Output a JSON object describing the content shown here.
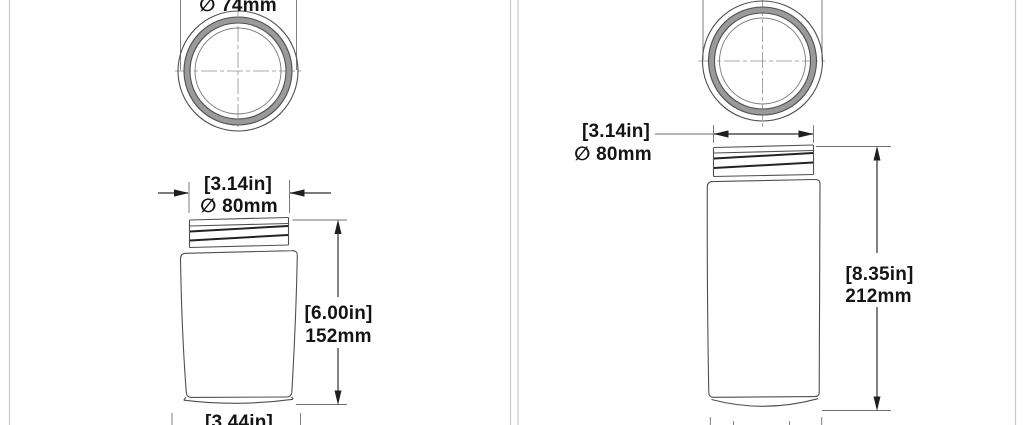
{
  "sheet": {
    "background": "#ffffff",
    "panel_border_color": "#c9c9c9",
    "outline_color": "#4f4f4f",
    "thread_color": "#232323",
    "dimension_color": "#2d2d2d",
    "centerline_color": "#8f8f8f",
    "text_color": "#141414"
  },
  "left_drawing": {
    "top_view": {
      "diameter_label": "∅ 74mm"
    },
    "neck_dimension": {
      "inches": "[3.14in]",
      "metric": "∅ 80mm"
    },
    "height_dimension": {
      "inches": "[6.00in]",
      "metric": "152mm"
    },
    "base_dimension": {
      "inches": "[3.44in]"
    }
  },
  "right_drawing": {
    "neck_dimension": {
      "inches": "[3.14in]",
      "metric": "∅ 80mm"
    },
    "height_dimension": {
      "inches": "[8.35in]",
      "metric": "212mm"
    }
  }
}
